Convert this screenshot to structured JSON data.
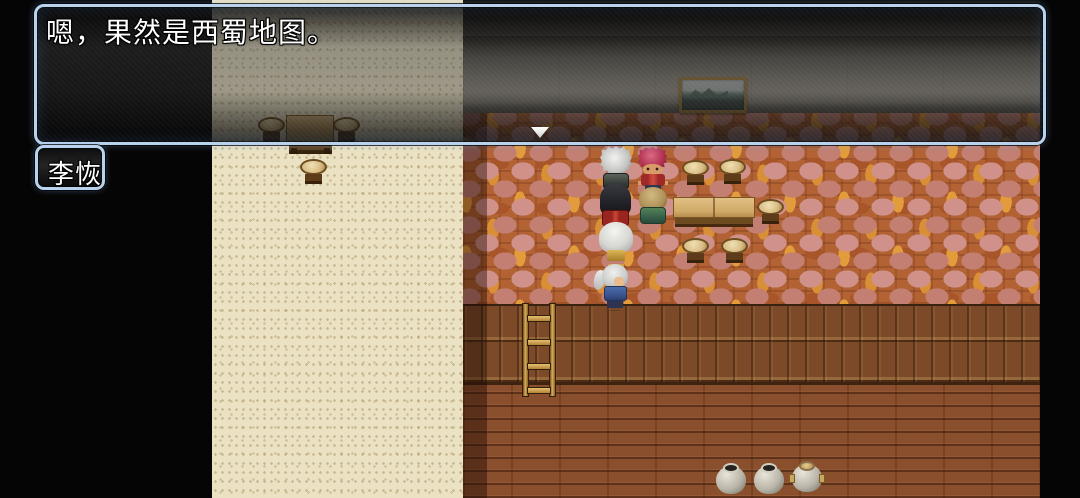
{
  "dialogue": {
    "message": "嗯，果然是西蜀地图。",
    "speaker_name": "李恢"
  },
  "icons": {
    "pause_cursor": "down-triangle"
  },
  "scene": {
    "visible_objects": [
      "landscape-painting",
      "long-table",
      "counter-table",
      "round-stools",
      "wooden-ladder",
      "ceramic-pots",
      "six-character-sprites"
    ]
  },
  "colors": {
    "window_border": "#b9d2ee",
    "window_bg": "#1a1a1a",
    "text": "#ffffff",
    "parchment_border": "#ebe2c4",
    "brick_base": "#b26233",
    "brick_pink": "#cf9189",
    "brick_orange": "#e39c3c",
    "panel_wood": "#7c4a28",
    "floor_wood": "#8a4f2c",
    "gray_wall": "#8b867c",
    "ladder_wood": "#d8ac58",
    "outside_map": "#050505"
  }
}
